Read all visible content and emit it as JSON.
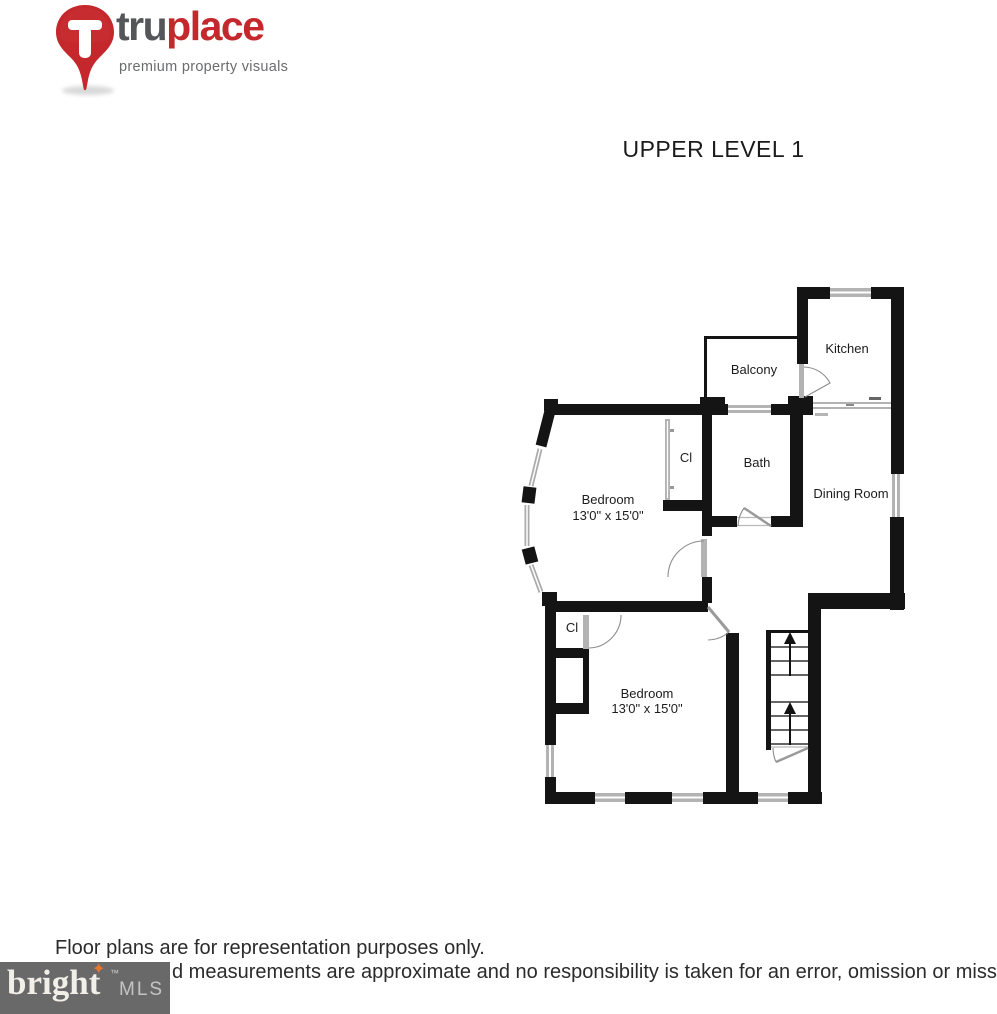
{
  "header": {
    "truplace": {
      "word_dark": "tru",
      "word_red": "place",
      "tagline": "premium property visuals",
      "brand_red": "#c4272c",
      "brand_gray": "#55565a"
    }
  },
  "title": "UPPER LEVEL 1",
  "floorplan": {
    "rooms": {
      "kitchen": "Kitchen",
      "balcony": "Balcony",
      "bath": "Bath",
      "dining": "Dining Room",
      "closet_upper": "Cl",
      "closet_lower": "Cl",
      "bedroom_upper": {
        "name": "Bedroom",
        "dims": "13'0\" x 15'0\""
      },
      "bedroom_lower": {
        "name": "Bedroom",
        "dims": "13'0\" x 15'0\""
      }
    },
    "wall_color": "#141414",
    "window_color": "#b3b3b3"
  },
  "footer": {
    "disclaimer_line1": "Floor plans are for representation purposes only.",
    "disclaimer_line2": "d measurements are approximate and no responsibility is taken for an error, omission or misstatement",
    "brightmls": {
      "word": "bright",
      "star": "✦",
      "tm": "™",
      "suffix": "MLS",
      "bg": "#6a696a"
    }
  }
}
